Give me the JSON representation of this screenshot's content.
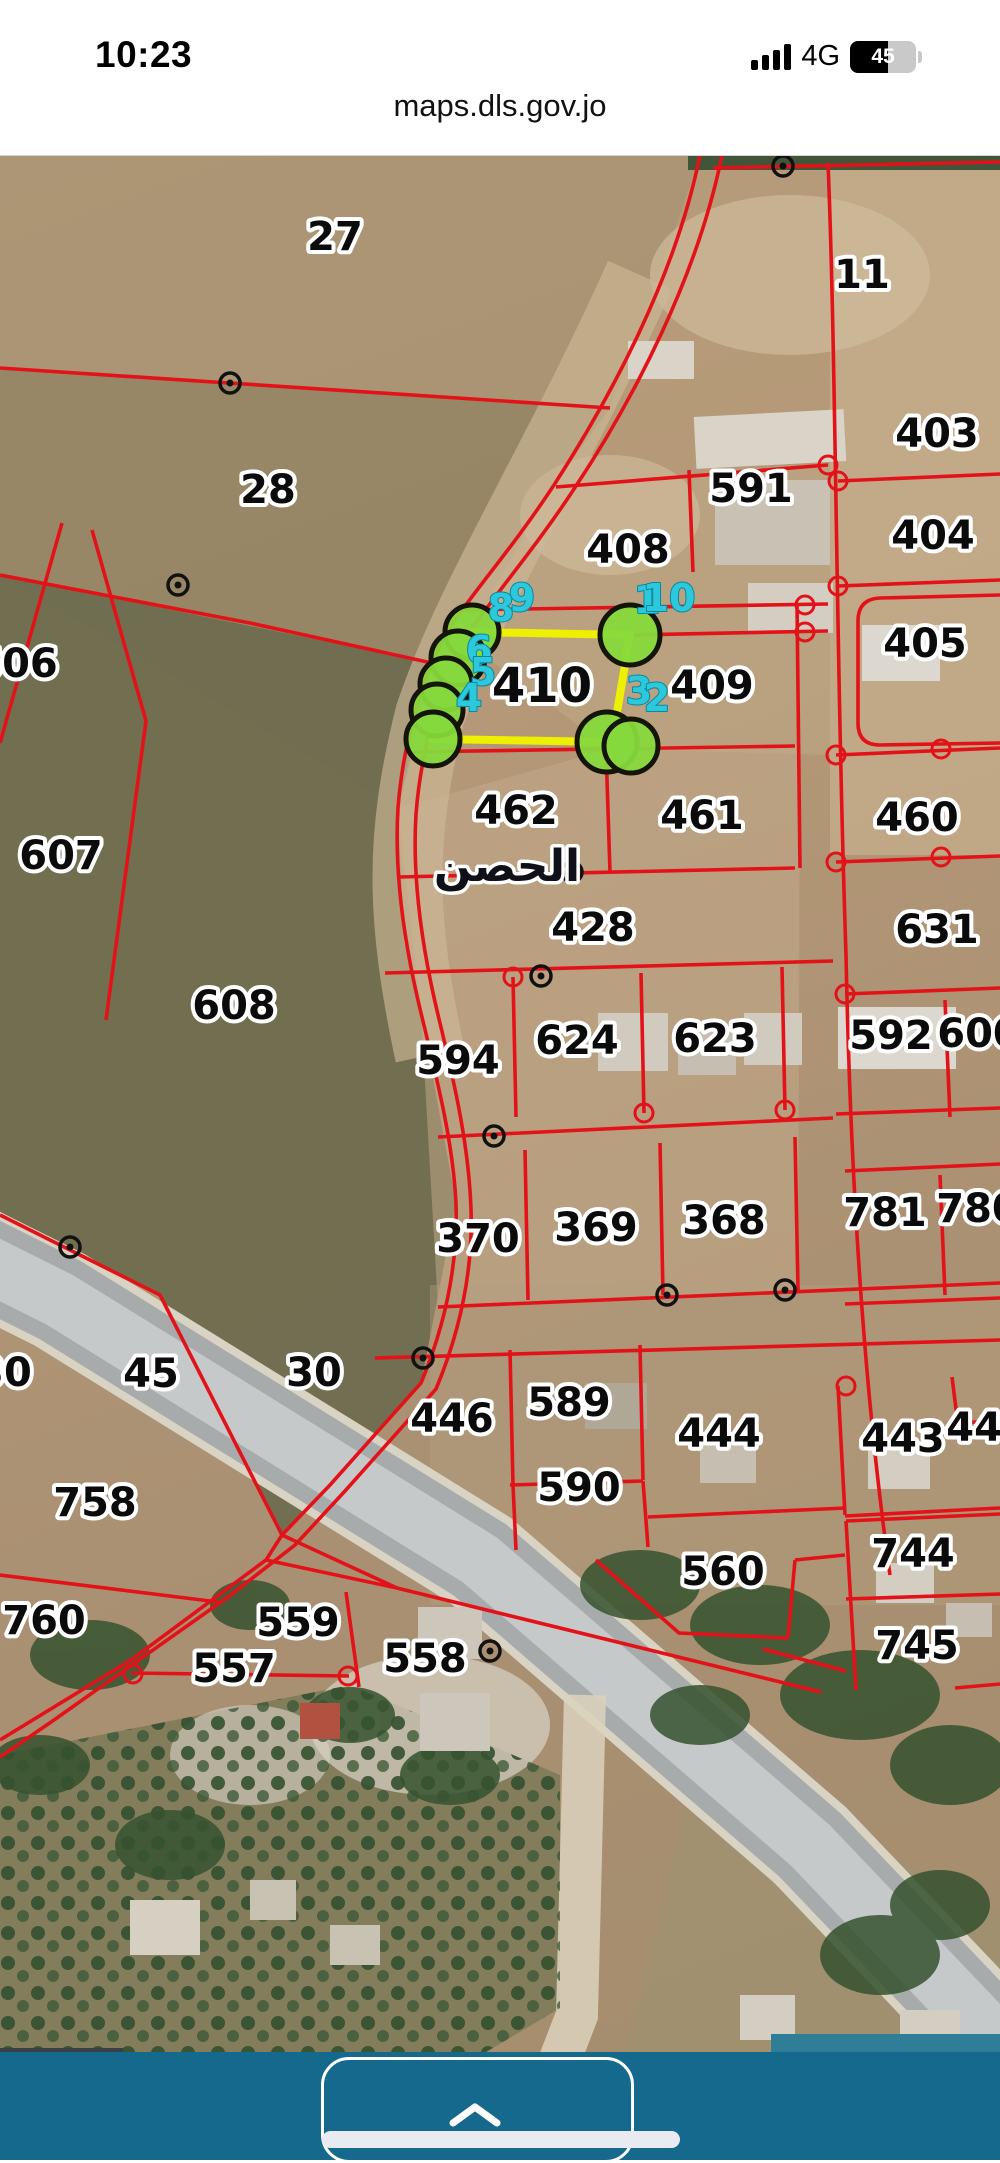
{
  "status_bar": {
    "time": "10:23",
    "network": "4G",
    "battery_percent": "45"
  },
  "browser": {
    "url": "maps.dls.gov.jo"
  },
  "map": {
    "place_label_ar": "الحصن",
    "place_label_pos": {
      "x": 507,
      "y": 726
    },
    "coordinate_readout": "35.86352,3",
    "attribution": "Pow",
    "line_color": "#e31219",
    "selected_parcel": {
      "id": "410",
      "outline_color": "#edf000",
      "vertex_color": "#86d93c",
      "outline_px": "472,477 630,480 612,587 433,584",
      "vertex_circles": [
        {
          "x": 472,
          "y": 477,
          "r": 27
        },
        {
          "x": 458,
          "y": 503,
          "r": 27
        },
        {
          "x": 446,
          "y": 529,
          "r": 26
        },
        {
          "x": 437,
          "y": 555,
          "r": 26
        },
        {
          "x": 433,
          "y": 584,
          "r": 27
        },
        {
          "x": 630,
          "y": 480,
          "r": 30
        },
        {
          "x": 607,
          "y": 587,
          "r": 30
        },
        {
          "x": 631,
          "y": 591,
          "r": 27
        }
      ],
      "vertex_numbers": [
        {
          "n": "1",
          "x": 647,
          "y": 458
        },
        {
          "n": "10",
          "x": 669,
          "y": 456
        },
        {
          "n": "9",
          "x": 522,
          "y": 456
        },
        {
          "n": "8",
          "x": 501,
          "y": 466
        },
        {
          "n": "6",
          "x": 479,
          "y": 508
        },
        {
          "n": "5",
          "x": 483,
          "y": 530
        },
        {
          "n": "4",
          "x": 469,
          "y": 556
        },
        {
          "n": "3",
          "x": 639,
          "y": 549
        },
        {
          "n": "2",
          "x": 657,
          "y": 556
        }
      ]
    },
    "parcels": [
      {
        "label": "27",
        "x": 335,
        "y": 95
      },
      {
        "label": "11",
        "x": 862,
        "y": 133
      },
      {
        "label": "403",
        "x": 937,
        "y": 292
      },
      {
        "label": "28",
        "x": 268,
        "y": 348
      },
      {
        "label": "591",
        "x": 751,
        "y": 347
      },
      {
        "label": "404",
        "x": 933,
        "y": 394
      },
      {
        "label": "408",
        "x": 628,
        "y": 408
      },
      {
        "label": "606",
        "x": 16,
        "y": 522
      },
      {
        "label": "405",
        "x": 925,
        "y": 502
      },
      {
        "label": "410",
        "x": 542,
        "y": 547,
        "large": true
      },
      {
        "label": "409",
        "x": 712,
        "y": 544
      },
      {
        "label": "462",
        "x": 516,
        "y": 669
      },
      {
        "label": "461",
        "x": 702,
        "y": 674
      },
      {
        "label": "460",
        "x": 917,
        "y": 676
      },
      {
        "label": "607",
        "x": 61,
        "y": 714
      },
      {
        "label": "428",
        "x": 593,
        "y": 786
      },
      {
        "label": "631",
        "x": 937,
        "y": 788
      },
      {
        "label": "608",
        "x": 234,
        "y": 864
      },
      {
        "label": "594",
        "x": 458,
        "y": 919
      },
      {
        "label": "624",
        "x": 577,
        "y": 899
      },
      {
        "label": "623",
        "x": 715,
        "y": 897
      },
      {
        "label": "592",
        "x": 891,
        "y": 894
      },
      {
        "label": "600",
        "x": 979,
        "y": 892
      },
      {
        "label": "370",
        "x": 478,
        "y": 1097
      },
      {
        "label": "369",
        "x": 596,
        "y": 1086
      },
      {
        "label": "368",
        "x": 724,
        "y": 1079
      },
      {
        "label": "781",
        "x": 885,
        "y": 1071
      },
      {
        "label": "780",
        "x": 978,
        "y": 1067
      },
      {
        "label": "30",
        "x": 4,
        "y": 1231
      },
      {
        "label": "45",
        "x": 151,
        "y": 1232
      },
      {
        "label": "30",
        "x": 314,
        "y": 1231
      },
      {
        "label": "446",
        "x": 452,
        "y": 1277
      },
      {
        "label": "589",
        "x": 569,
        "y": 1261
      },
      {
        "label": "444",
        "x": 719,
        "y": 1292
      },
      {
        "label": "443",
        "x": 903,
        "y": 1297
      },
      {
        "label": "442",
        "x": 988,
        "y": 1286
      },
      {
        "label": "758",
        "x": 95,
        "y": 1361
      },
      {
        "label": "590",
        "x": 579,
        "y": 1346
      },
      {
        "label": "560",
        "x": 723,
        "y": 1430
      },
      {
        "label": "744",
        "x": 913,
        "y": 1412
      },
      {
        "label": "760",
        "x": 44,
        "y": 1479
      },
      {
        "label": "559",
        "x": 298,
        "y": 1481
      },
      {
        "label": "745",
        "x": 917,
        "y": 1504
      },
      {
        "label": "557",
        "x": 234,
        "y": 1527
      },
      {
        "label": "558",
        "x": 425,
        "y": 1517
      }
    ]
  },
  "footer": {
    "handle_chevron": "up"
  }
}
